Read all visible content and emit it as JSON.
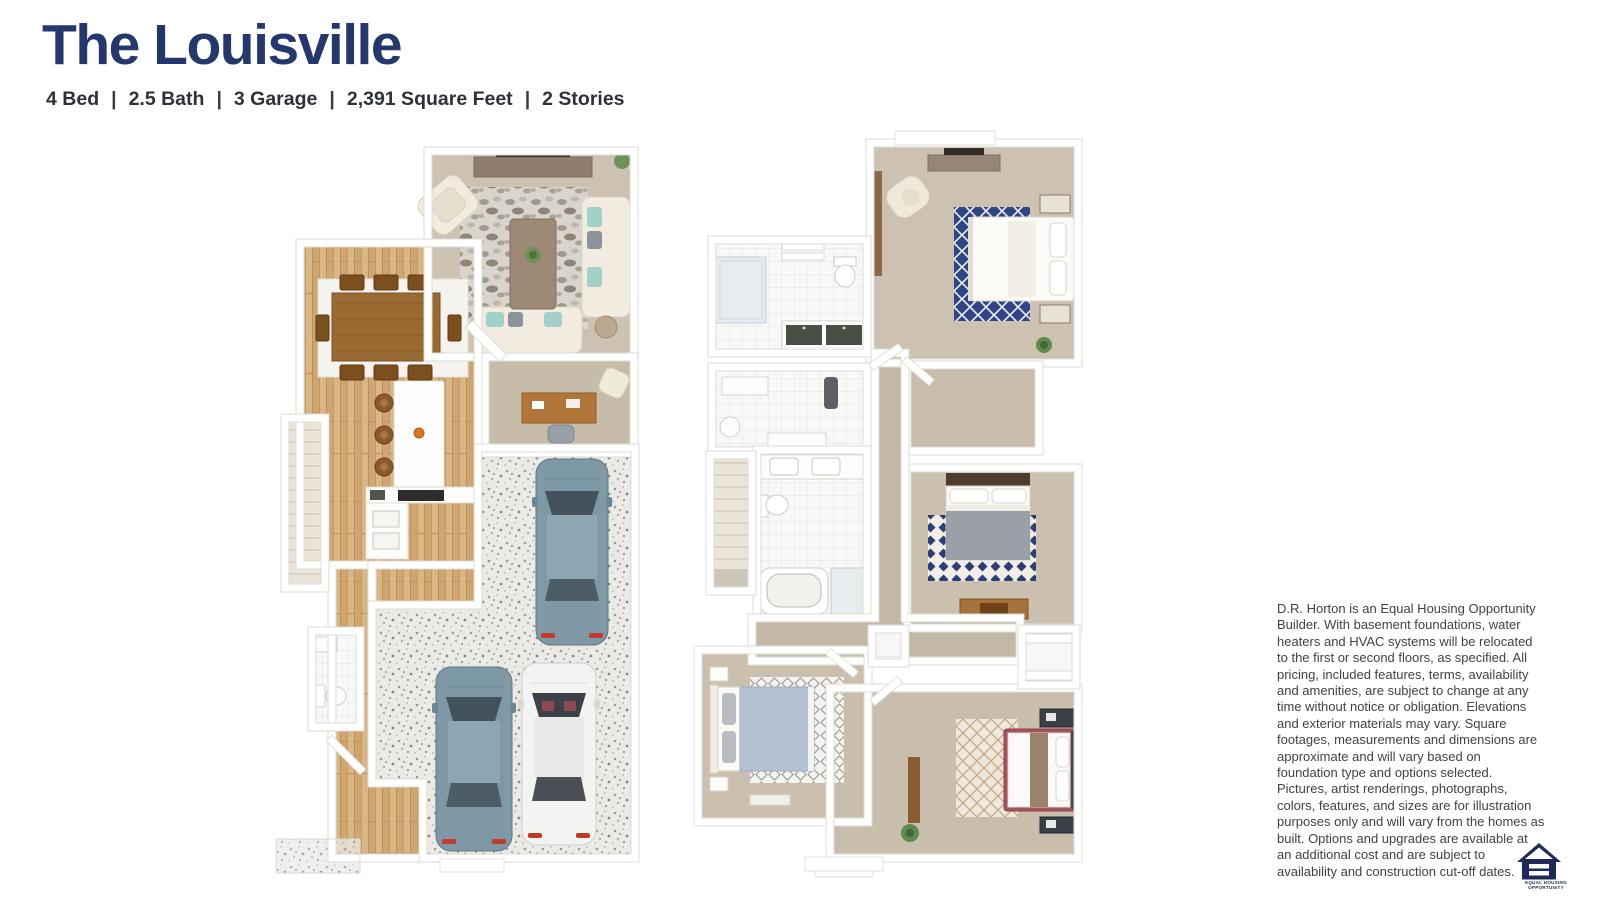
{
  "header": {
    "title": "The Louisville",
    "specs": [
      "4 Bed",
      "2.5 Bath",
      "3 Garage",
      "2,391 Square Feet",
      "2 Stories"
    ],
    "specs_divider": "|"
  },
  "disclaimer": {
    "text": "D.R. Horton is an Equal Housing Opportunity Builder. With basement foundations, water heaters and HVAC systems will be relocated to the first or second floors, as specified. All pricing, included features, terms, availability and amenities, are subject to change at any time without notice or obligation. Elevations and exterior materials may vary. Square footages, measurements and dimensions are approximate and will vary based on foundation type and options selected. Pictures, artist renderings, photographs, colors, features, and sizes are for illustration purposes only and will vary from the homes as built. Options and upgrades are available at an additional cost and are subject to availability and construction cut-off dates."
  },
  "equal_housing_logo": {
    "line1": "EQUAL HOUSING",
    "line2": "OPPORTUNITY"
  },
  "colors": {
    "title_navy": "#24386e",
    "specs_text": "#2e3237",
    "disclaimer_text": "#424242",
    "logo_navy": "#1e2a5a",
    "background": "#ffffff",
    "wood_floor": "#d9b785",
    "carpet_beige": "#cdc1b1",
    "tile_white": "#f8f8f6",
    "garage_speckle": "#eceae7",
    "rug_navy": "#2f4586",
    "car_slate_blue": "#7e98a6",
    "car_white": "#f3f3f1",
    "taillight_red": "#c2392e"
  }
}
